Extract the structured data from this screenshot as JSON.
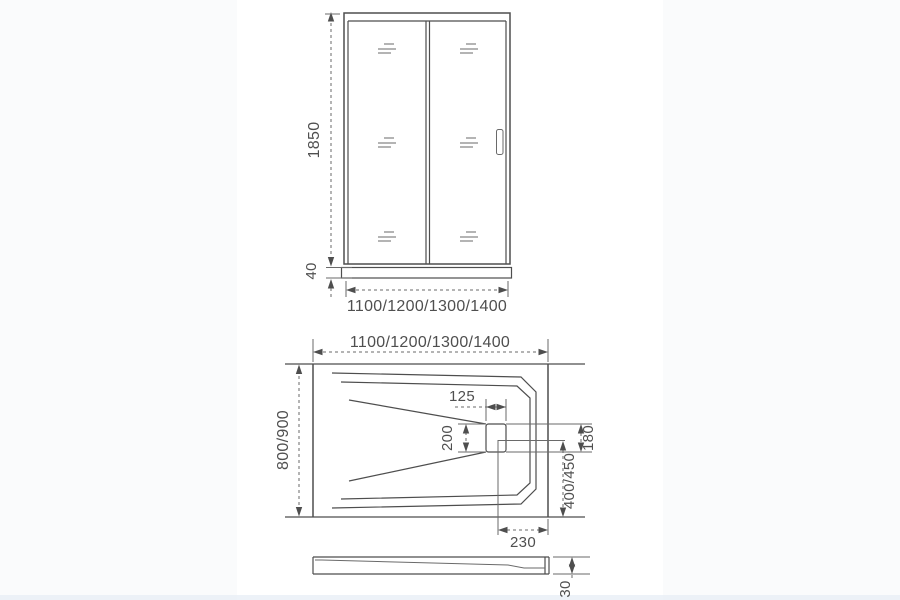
{
  "canvas": {
    "bg": "#fafbfc",
    "card_bg": "#ffffff",
    "line_color": "#4e4e4e",
    "thin_line_color": "#6a6a6a",
    "text_color": "#4f4f4f",
    "bottom_strip": "#e7eef5"
  },
  "front_view": {
    "title": "shower-door-front-elevation",
    "dims": {
      "height": "1850",
      "sill_height": "40",
      "width_options": "1100/1200/1300/1400"
    }
  },
  "top_view": {
    "title": "shower-tray-top-view",
    "dims": {
      "width_options": "1100/1200/1300/1400",
      "depth_options": "800/900",
      "drain_pocket_width": "125",
      "drain_pocket_height": "200",
      "drain_offset_side": "180",
      "drain_offset_back": "400/450",
      "drain_corner_offset": "230"
    }
  },
  "side_view": {
    "title": "shower-tray-side-profile",
    "dims": {
      "tray_height": "30"
    }
  }
}
